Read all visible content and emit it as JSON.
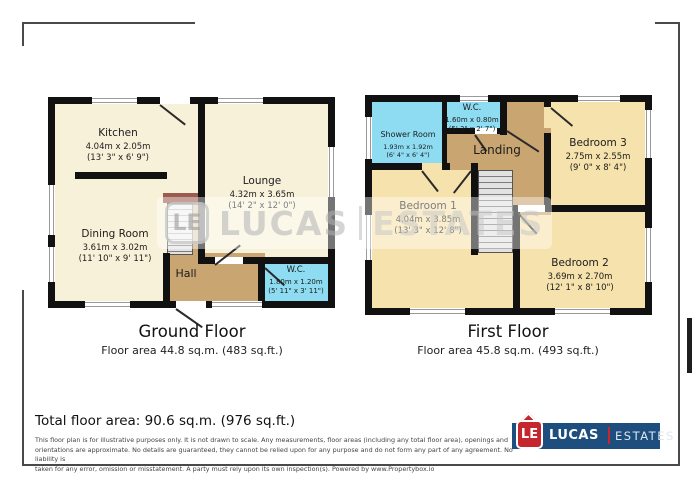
{
  "ground_floor": {
    "title": "Ground Floor",
    "area_label": "Floor area 44.8 sq.m. (483 sq.ft.)",
    "rooms": [
      {
        "name": "Kitchen",
        "metric": "4.04m x 2.05m",
        "imperial": "(13' 3\" x 6' 9\")"
      },
      {
        "name": "Lounge",
        "metric": "4.32m x 3.65m",
        "imperial": "(14' 2\" x 12' 0\")"
      },
      {
        "name": "Dining Room",
        "metric": "3.61m x 3.02m",
        "imperial": "(11' 10\" x 9' 11\")"
      },
      {
        "name": "Hall"
      },
      {
        "name": "W.C.",
        "metric": "1.80m x 1.20m",
        "imperial": "(5' 11\" x 3' 11\")"
      }
    ]
  },
  "first_floor": {
    "title": "First Floor",
    "area_label": "Floor area 45.8 sq.m. (493 sq.ft.)",
    "rooms": [
      {
        "name": "Shower Room",
        "metric": "1.93m x 1.92m",
        "imperial": "(6' 4\" x 6' 4\")"
      },
      {
        "name": "W.C.",
        "metric": "1.60m x 0.80m",
        "imperial": "(5' 3\" x 2' 7\")"
      },
      {
        "name": "Landing"
      },
      {
        "name": "Bedroom 3",
        "metric": "2.75m x 2.55m",
        "imperial": "(9' 0\" x 8' 4\")"
      },
      {
        "name": "Bedroom 1",
        "metric": "4.04m x 3.85m",
        "imperial": "(13' 3\" x 12' 8\")"
      },
      {
        "name": "Bedroom 2",
        "metric": "3.69m x 2.70m",
        "imperial": "(12' 1\" x 8' 10\")"
      }
    ]
  },
  "total_area": "Total floor area: 90.6 sq.m. (976 sq.ft.)",
  "disclaimer": {
    "line1": "This floor plan is for illustrative purposes only. It is not drawn to scale. Any measurements, floor areas (including any total floor area), openings and",
    "line2": "orientations are approximate. No details are guaranteed, they cannot be relied upon for any purpose and do not form any part of any agreement. No liability is",
    "line3": "taken for any error, omission or misstatement. A party must rely upon its own inspection(s). Powered by www.Propertybox.io"
  },
  "watermark": {
    "le": "LE",
    "lucas": "LUCAS",
    "estates": "ESTATES"
  },
  "logo": {
    "le": "LE",
    "lucas": "LUCAS",
    "estates": "ESTATES"
  },
  "colors": {
    "wall": "#111111",
    "room_cream": "#f8f1da",
    "room_wheat": "#f6e2ac",
    "wet_room_cyan": "#8ddcf1",
    "hall_tan": "#c9a571",
    "stair_top_brown": "#9b5b4f",
    "logo_red": "#c4272e",
    "logo_blue": "#1d4e7e"
  }
}
